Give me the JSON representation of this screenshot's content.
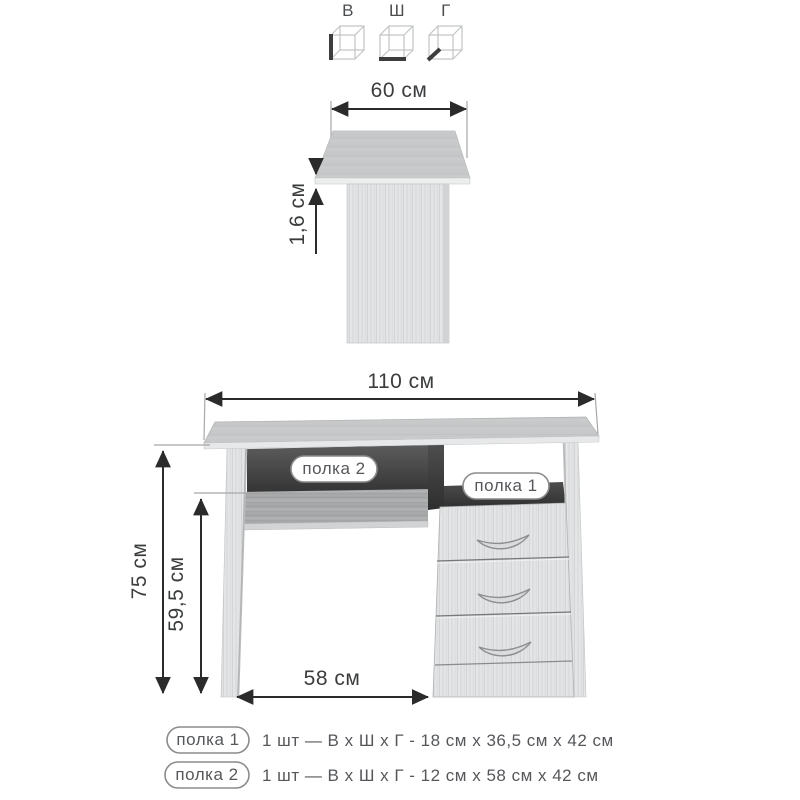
{
  "dimension_cubes": {
    "height_label": "В",
    "width_label": "Ш",
    "depth_label": "Г"
  },
  "side_view": {
    "top_width": "60 см",
    "top_thickness": "1,6 см"
  },
  "front_view": {
    "total_width": "110 см",
    "total_height": "75 см",
    "underdesk_height": "59,5 см",
    "underdesk_width": "58 см",
    "shelf2_label": "полка 2",
    "shelf1_label": "полка 1"
  },
  "legend": {
    "rows": [
      {
        "badge": "полка 1",
        "desc": "1 шт — В х Ш х Г - 18 см х 36,5 см х 42 см"
      },
      {
        "badge": "полка 2",
        "desc": "1 шт — В х Ш х Г - 12 см х 58 см х 42 см"
      }
    ]
  },
  "colors": {
    "background": "#ffffff",
    "wood_light": "#e4e5e6",
    "wood_top": "#c7c8c9",
    "apron_wood": "#a8aaab",
    "niche_dark": "#3f3f3f",
    "dimension_line": "#2b2b2b",
    "text_gray": "#55575a",
    "badge_border": "#8a8b8c"
  }
}
